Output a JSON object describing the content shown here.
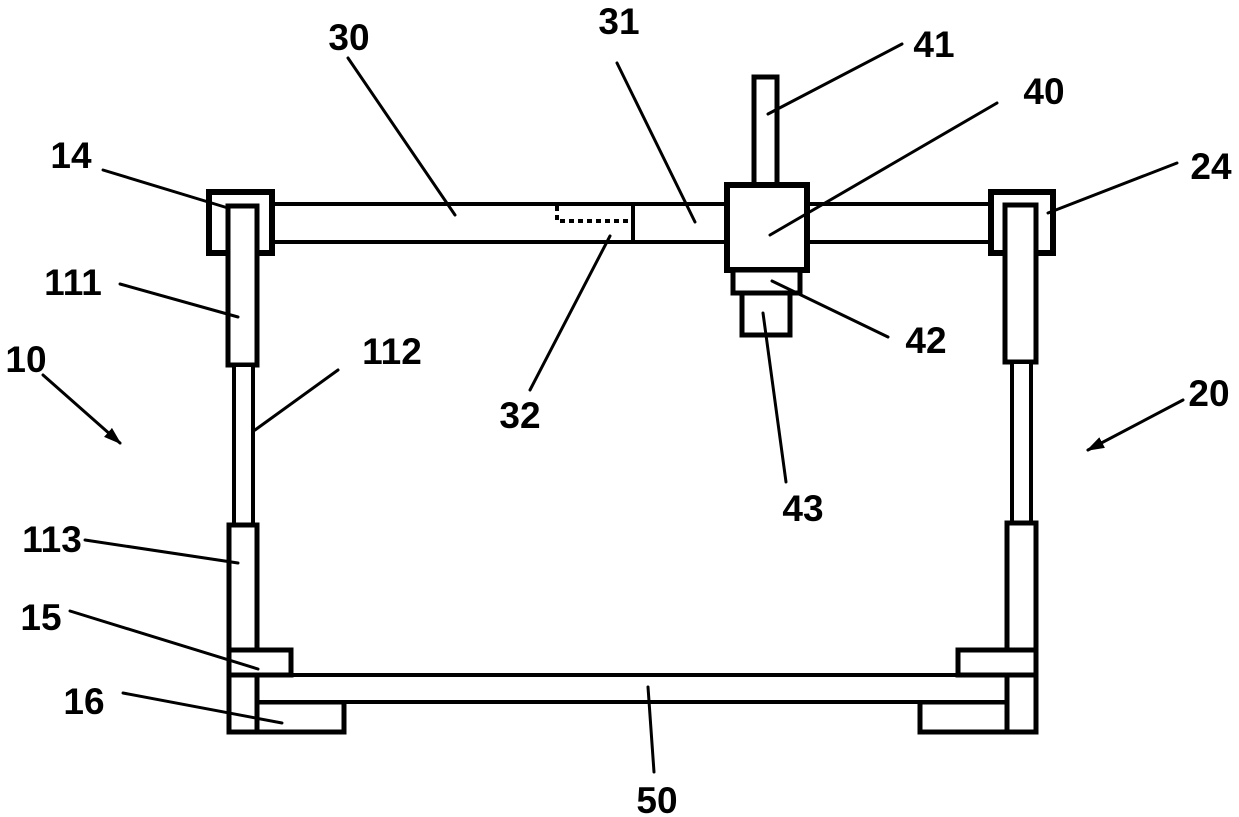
{
  "figure": {
    "background_color": "#ffffff",
    "line_color": "#000000",
    "labels": {
      "n10": "10",
      "n14": "14",
      "n15": "15",
      "n16": "16",
      "n20": "20",
      "n24": "24",
      "n30": "30",
      "n31": "31",
      "n32": "32",
      "n40": "40",
      "n41": "41",
      "n42": "42",
      "n43": "43",
      "n50": "50",
      "n111": "111",
      "n112": "112",
      "n113": "113"
    }
  }
}
